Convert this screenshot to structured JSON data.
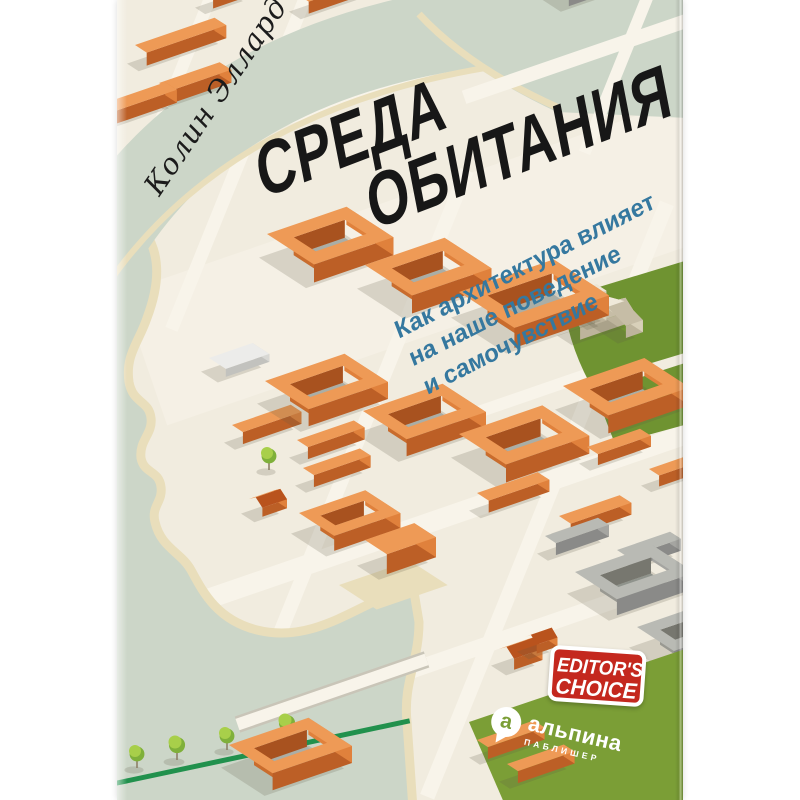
{
  "book_cover": {
    "author": "Колин Эллард",
    "title": {
      "line1": "СРЕДА",
      "line2": "ОБИТАНИЯ"
    },
    "subtitle": {
      "line1": "Как архитектура влияет",
      "line2": "на наше поведение",
      "line3": "и самочувствие"
    },
    "badge": {
      "line1": "EDITOR'S",
      "line2": "CHOICE",
      "color": "#c4281e"
    },
    "publisher": {
      "name": "альпина",
      "type": "ПАБЛИШЕР"
    },
    "icons": {
      "publisher_pin": "alpina-pin-icon"
    },
    "colors": {
      "title": "#171717",
      "author": "#1b1b1b",
      "subtitle": "#35789f",
      "cream": "#f1ecdf",
      "road": "#f8f4ea",
      "plaza": "#f5f0e5",
      "water": "#ccd6c8",
      "sand": "#e9debb",
      "park": "#6f9331",
      "logo_green": "#7b9e36",
      "hedge": "#21914d",
      "shadow": "rgba(95,90,72,0.20)",
      "orange_top": "#ee9a56",
      "orange_dark": "#bc5f26",
      "orange_mid": "#e0813c",
      "courtyard_floor": "#aaaea6",
      "gray_top": "#b9bab4",
      "gray_dark": "#8a8a88",
      "gray_mid": "#a5a5a1",
      "white_top": "#ececea",
      "church_cream": "#ece6d6"
    }
  }
}
